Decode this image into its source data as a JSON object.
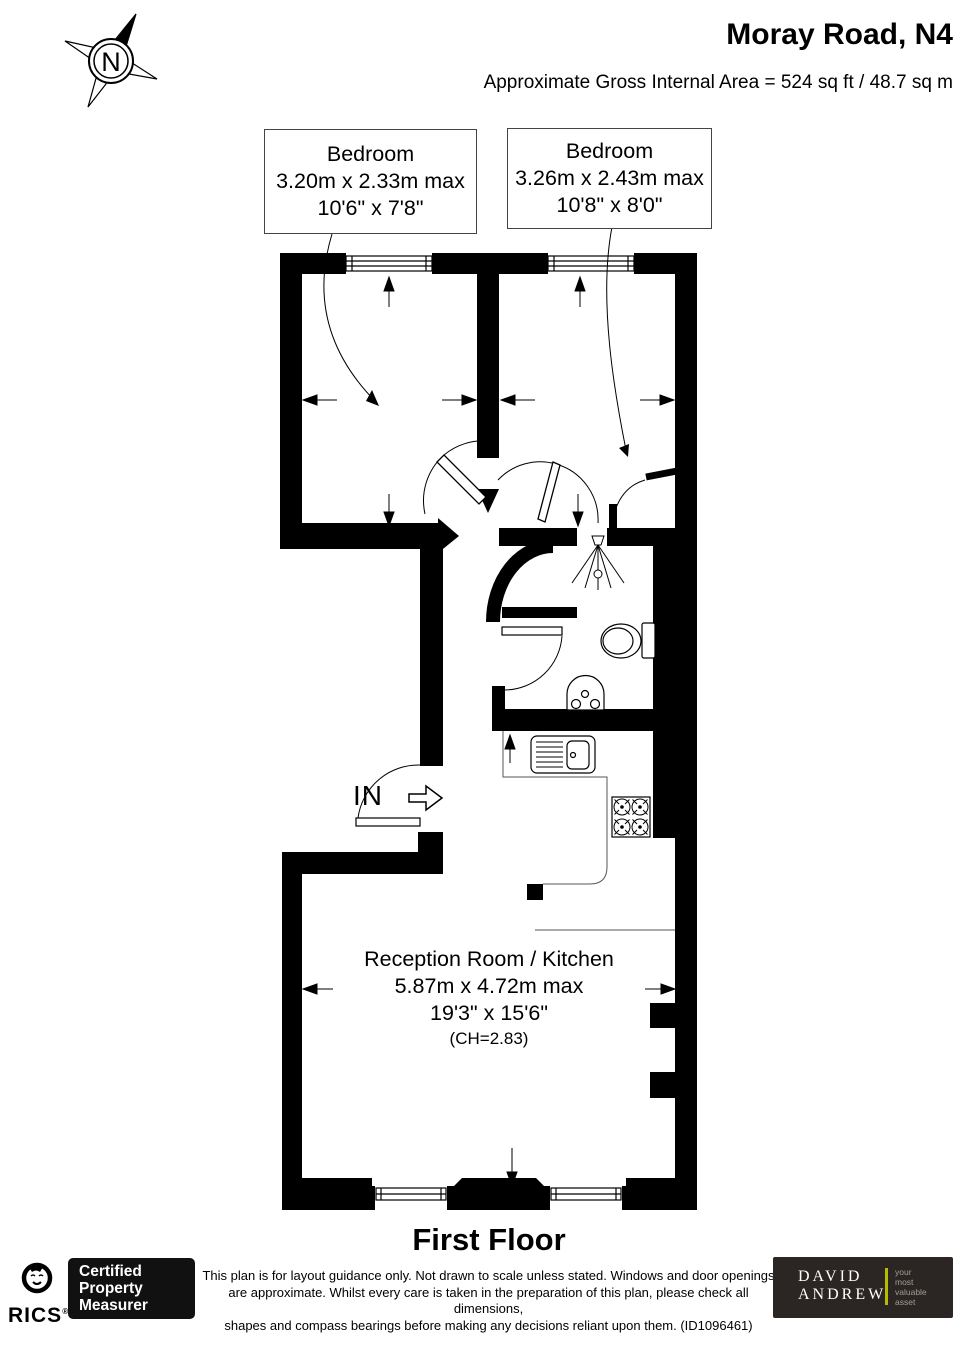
{
  "header": {
    "title": "Moray Road, N4",
    "area": "Approximate Gross Internal Area =  524 sq ft / 48.7 sq m"
  },
  "compass": {
    "letter": "N"
  },
  "rooms": {
    "bedroom1": {
      "name": "Bedroom",
      "metric": "3.20m x 2.33m max",
      "imperial": "10'6\" x 7'8\""
    },
    "bedroom2": {
      "name": "Bedroom",
      "metric": "3.26m x 2.43m max",
      "imperial": "10'8\" x 8'0\""
    },
    "reception": {
      "name": "Reception Room / Kitchen",
      "metric": "5.87m x 4.72m max",
      "imperial": "19'3\" x 15'6\"",
      "ceiling_height": "(CH=2.83)"
    }
  },
  "entrance": {
    "label": "IN"
  },
  "floor": {
    "label": "First Floor"
  },
  "footer": {
    "rics": {
      "brand": "RICS",
      "registered": "®",
      "badge_lines": [
        "Certified",
        "Property",
        "Measurer"
      ]
    },
    "disclaimer": [
      "This plan is for layout guidance only. Not drawn to scale unless stated. Windows and door openings",
      "are approximate. Whilst every care is taken in the preparation of this plan, please check all dimensions,",
      "shapes and compass bearings before making any decisions reliant upon them. (ID1096461)"
    ],
    "agent": {
      "name_line1": "DAVID",
      "name_line2": "ANDREW",
      "tagline": [
        "your",
        "most",
        "valuable",
        "asset"
      ],
      "accent_color": "#b5bd00",
      "background_color": "#2b2623",
      "tagline_color": "#a39d96"
    }
  },
  "icons": {
    "compass": "compass-rose",
    "shower": "shower-spray",
    "toilet": "toilet",
    "basin": "pedestal-basin",
    "kitchen_sink": "sink-with-drainer",
    "hob": "four-burner-hob",
    "entry_arrow": "right-arrow"
  }
}
